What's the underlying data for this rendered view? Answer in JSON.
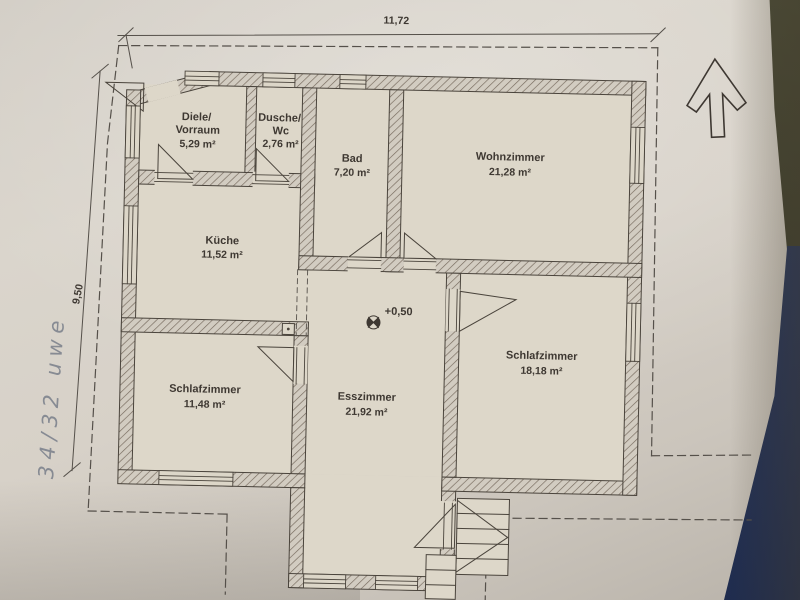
{
  "plan": {
    "rooms": [
      {
        "id": "diele",
        "line1": "Diele/",
        "line2": "Vorraum",
        "area": "5,29 m²"
      },
      {
        "id": "dusche-wc",
        "line1": "Dusche/",
        "line2": "Wc",
        "area": "2,76 m²"
      },
      {
        "id": "bad",
        "line1": "Bad",
        "area": "7,20 m²"
      },
      {
        "id": "wohnzimmer",
        "line1": "Wohnzimmer",
        "area": "21,28 m²"
      },
      {
        "id": "kueche",
        "line1": "Küche",
        "area": "11,52 m²"
      },
      {
        "id": "schlafzimmer-left",
        "line1": "Schlafzimmer",
        "area": "11,48 m²"
      },
      {
        "id": "esszimmer",
        "line1": "Esszimmer",
        "area": "21,92 m²"
      },
      {
        "id": "schlafzimmer-right",
        "line1": "Schlafzimmer",
        "area": "18,18 m²"
      }
    ],
    "dimensions": {
      "width": "11,72",
      "height": "9,50"
    },
    "level_marker": "+0,50",
    "handwritten_note": "34/32 uwe",
    "colors": {
      "paper": "#d7d1c8",
      "floor": "#ddd7c9",
      "ink": "#4a443c",
      "hatch": "#75695c",
      "pen_blue": "#68707f",
      "table_olive": "#3c3d2c",
      "table_blue": "#293760"
    }
  }
}
